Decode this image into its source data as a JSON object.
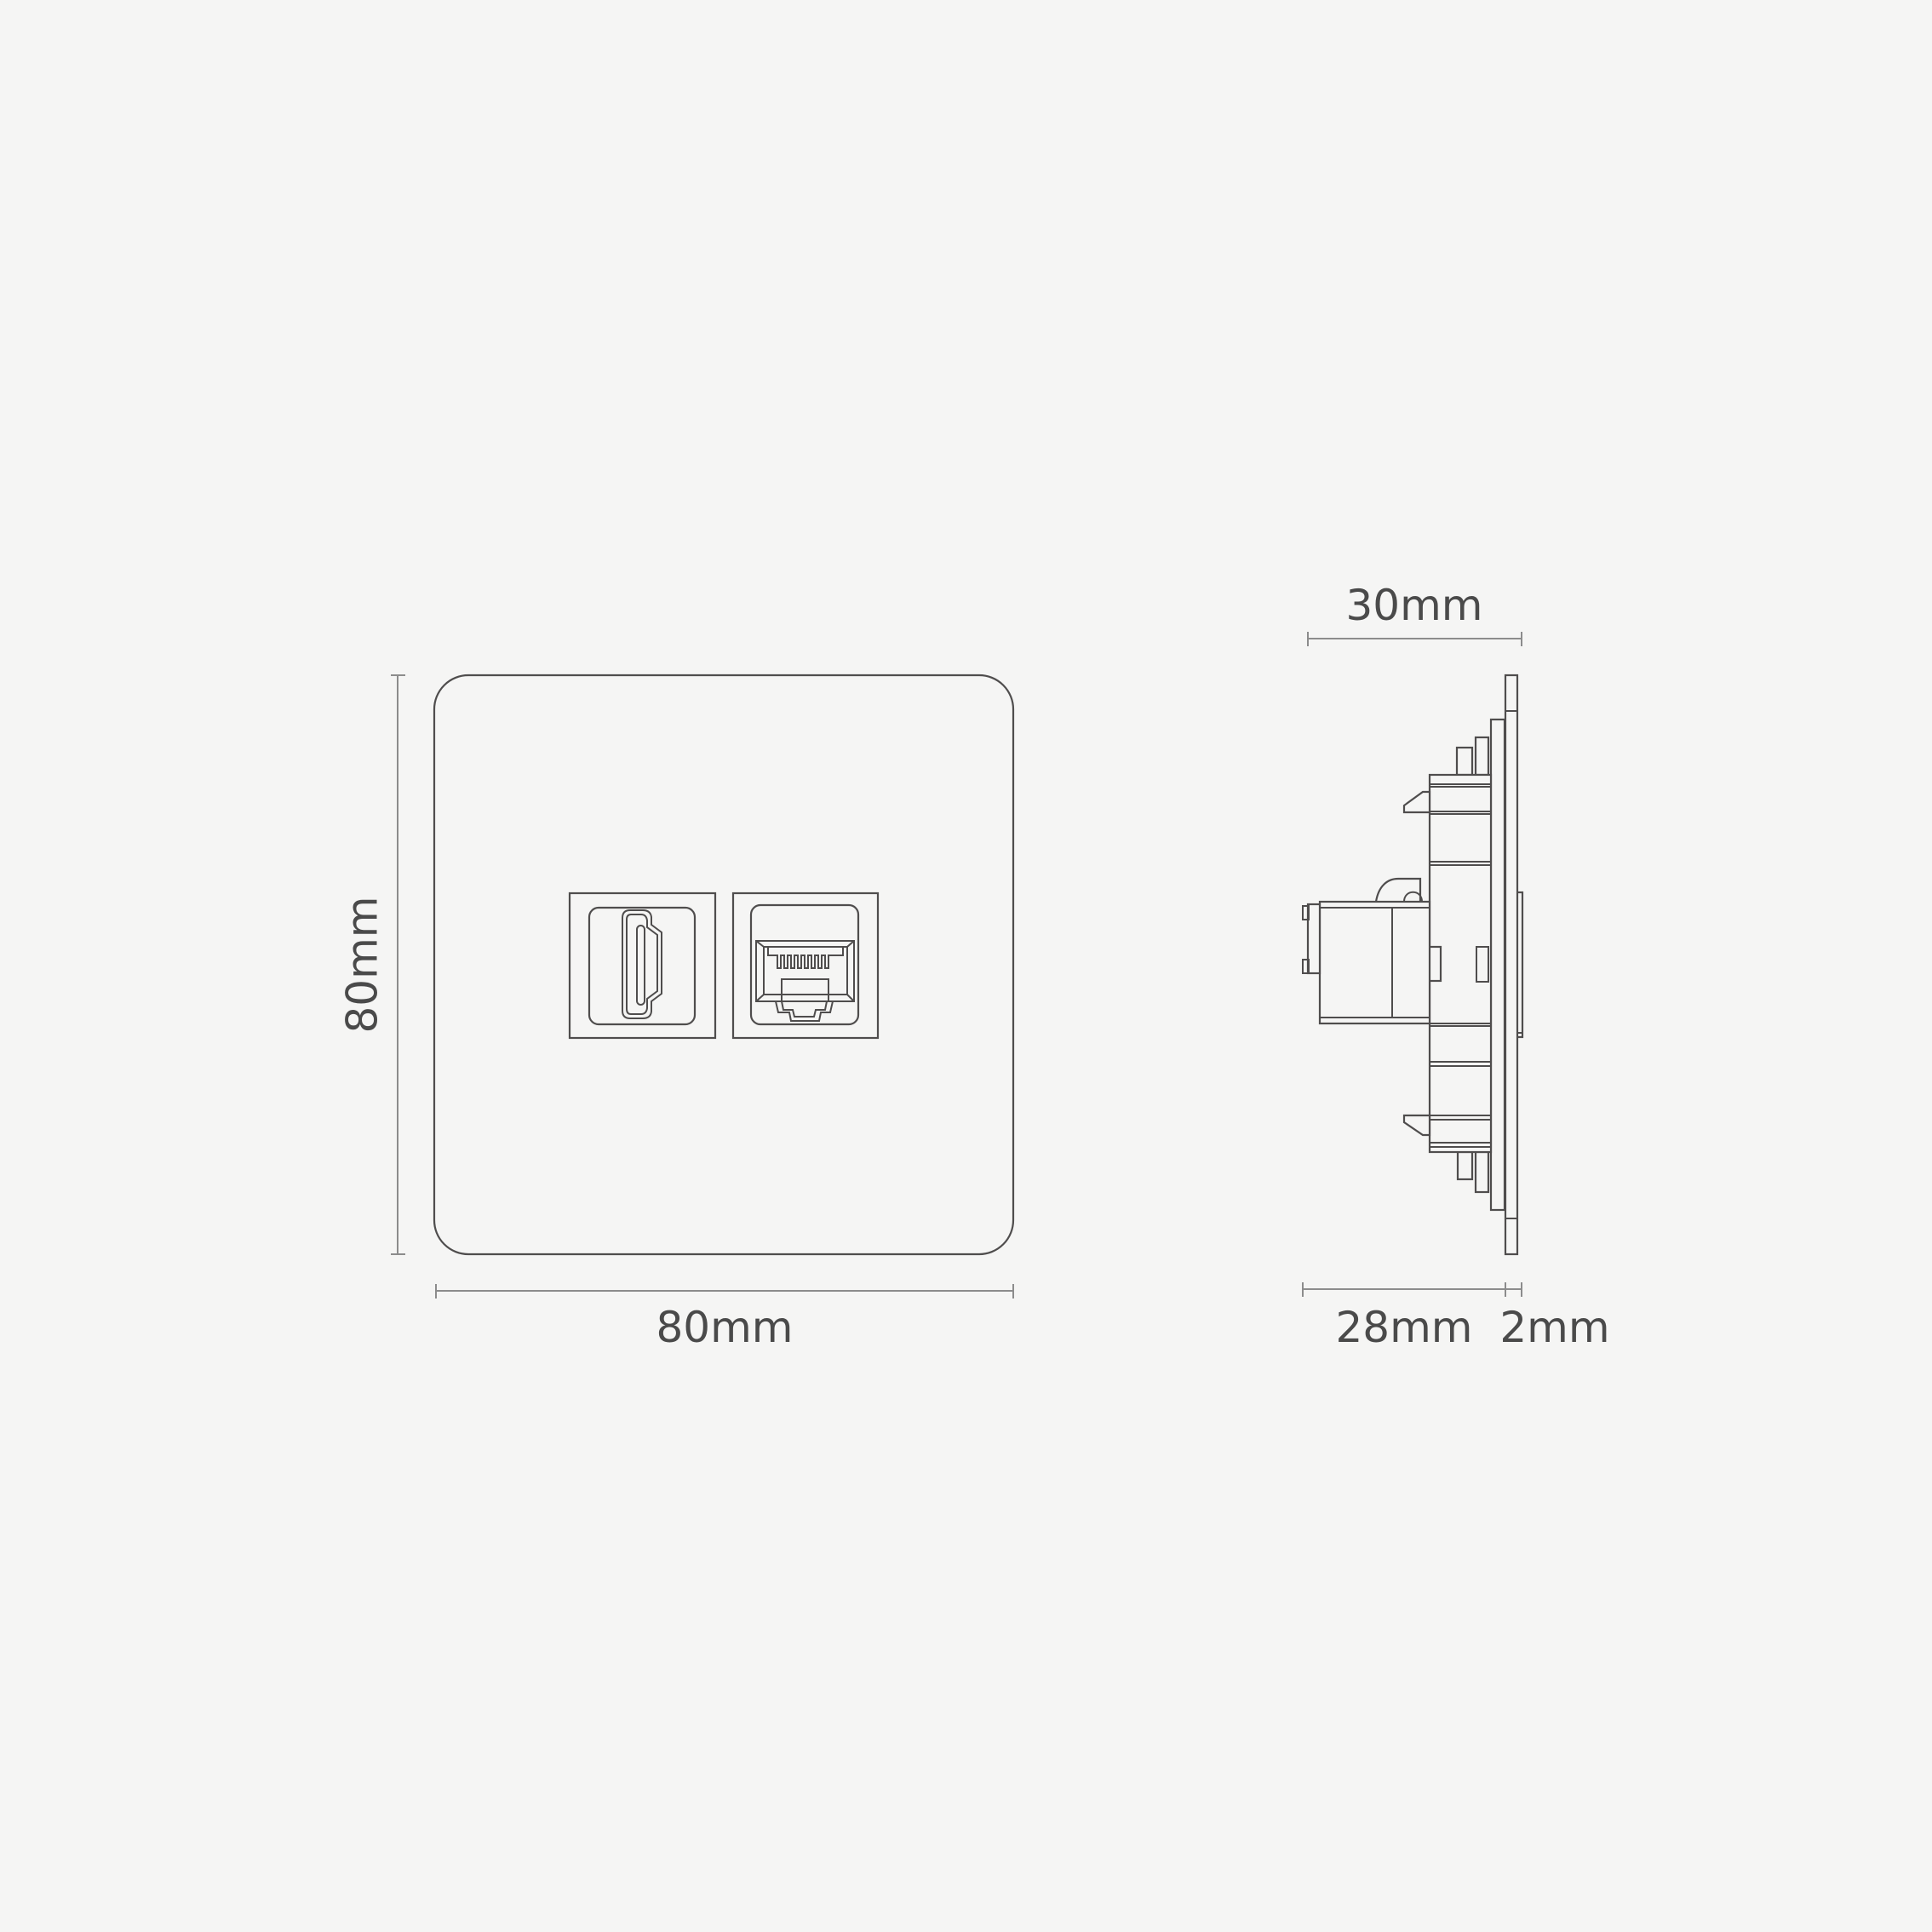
{
  "title": "HDMI and ethernet wall module technical dimension drawing",
  "background": "#f5f5f4",
  "colors": {
    "outline": "#4f4d4d",
    "dimension_line": "#8c8c8c",
    "label_text": "#4a4a4a"
  },
  "front_view": {
    "height_label": "80mm",
    "width_label": "80mm",
    "ports": [
      "hdmi",
      "ethernet-rj45"
    ]
  },
  "side_view": {
    "overall_depth_label": "30mm",
    "module_depth_label": "28mm",
    "plate_thickness_label": "2mm"
  }
}
